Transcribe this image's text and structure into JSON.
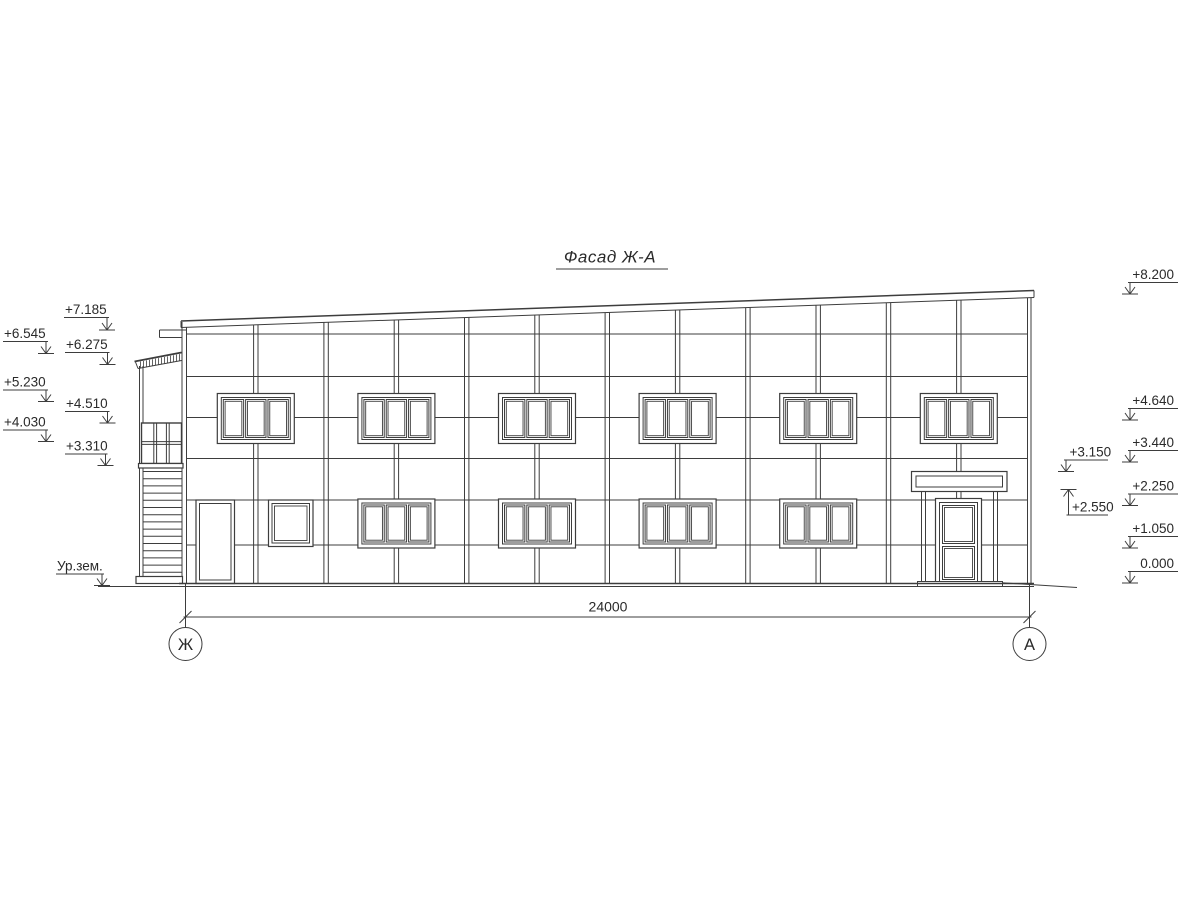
{
  "title": "Фасад Ж-А",
  "elevation_marks": {
    "left": [
      "+7.185",
      "+6.545",
      "+6.275",
      "+5.230",
      "+4.510",
      "+4.030",
      "+3.310",
      "Ур.зем."
    ],
    "right_outer": [
      "+8.200",
      "+4.640",
      "+3.440",
      "+2.250",
      "+1.050",
      "0.000"
    ],
    "right_inner": [
      "+3.150",
      "+2.550"
    ]
  },
  "dimension": {
    "label": "24000"
  },
  "axes": {
    "left": "Ж",
    "right": "А"
  },
  "colors": {
    "line": "#3d3d3d",
    "text": "#2a2a2a",
    "background": "#ffffff"
  }
}
